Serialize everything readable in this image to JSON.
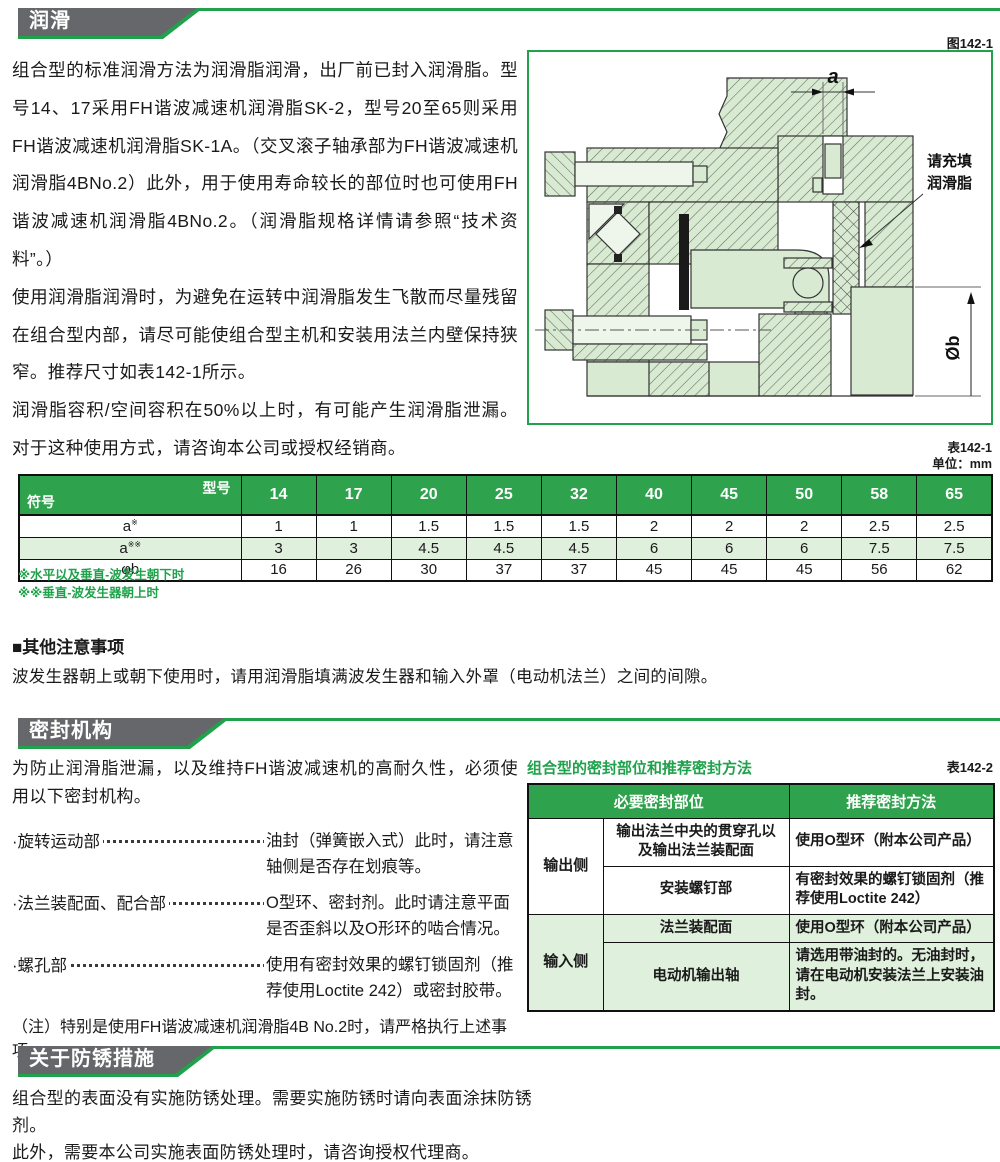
{
  "colors": {
    "green": "#1fa24b",
    "table_header_green": "#2fa24d",
    "light_green_row": "#dff0dc",
    "header_gray": "#66676a",
    "figure_fill": "#d9ead3"
  },
  "lubrication": {
    "header": "润滑",
    "paragraphs": [
      "组合型的标准润滑方法为润滑脂润滑，出厂前已封入润滑脂。型号14、17采用FH谐波减速机润滑脂SK-2，型号20至65则采用FH谐波减速机润滑脂SK-1A。（交叉滚子轴承部为FH谐波减速机润滑脂4BNo.2）此外，用于使用寿命较长的部位时也可使用FH谐波减速机润滑脂4BNo.2。（润滑脂规格详情请参照“技术资料”。）",
      "使用润滑脂润滑时，为避免在运转中润滑脂发生飞散而尽量残留在组合型内部，请尽可能使组合型主机和安装用法兰内壁保持狭窄。推荐尺寸如表142-1所示。",
      "润滑脂容积/空间容积在50%以上时，有可能产生润滑脂泄漏。对于这种使用方式，请咨询本公司或授权经销商。"
    ],
    "figure": {
      "label": "图142-1",
      "dim_a": "a",
      "dim_b": "Øb",
      "callout_line1": "请充填",
      "callout_line2": "润滑脂"
    },
    "table": {
      "label": "表142-1",
      "unit": "单位：mm",
      "corner_top": "型号",
      "corner_bottom": "符号",
      "columns": [
        "14",
        "17",
        "20",
        "25",
        "32",
        "40",
        "45",
        "50",
        "58",
        "65"
      ],
      "rows": [
        {
          "sym": "a",
          "sup": "※",
          "values": [
            "1",
            "1",
            "1.5",
            "1.5",
            "1.5",
            "2",
            "2",
            "2",
            "2.5",
            "2.5"
          ]
        },
        {
          "sym": "a",
          "sup": "※※",
          "values": [
            "3",
            "3",
            "4.5",
            "4.5",
            "4.5",
            "6",
            "6",
            "6",
            "7.5",
            "7.5"
          ]
        },
        {
          "sym": "φb",
          "sup": "",
          "values": [
            "16",
            "26",
            "30",
            "37",
            "37",
            "45",
            "45",
            "45",
            "56",
            "62"
          ]
        }
      ],
      "notes": [
        "※水平以及垂直-波发生朝下时",
        "※※垂直-波发生器朝上时"
      ]
    },
    "other": {
      "title": "■其他注意事项",
      "text": "波发生器朝上或朝下使用时，请用润滑脂填满波发生器和输入外罩（电动机法兰）之间的间隙。"
    }
  },
  "sealing": {
    "header": "密封机构",
    "intro": "为防止润滑脂泄漏，以及维持FH谐波减速机的高耐久性，必须使用以下密封机构。",
    "items": [
      {
        "label": "·旋转运动部",
        "desc": "油封（弹簧嵌入式）此时，请注意轴侧是否存在划痕等。"
      },
      {
        "label": "·法兰装配面、配合部",
        "desc": "O型环、密封剂。此时请注意平面是否歪斜以及O形环的啮合情况。"
      },
      {
        "label": "·螺孔部",
        "desc": "使用有密封效果的螺钉锁固剂（推荐使用Loctite 242）或密封胶带。"
      }
    ],
    "note": "（注）特别是使用FH谐波减速机润滑脂4B No.2时，请严格执行上述事项。",
    "table": {
      "title": "组合型的密封部位和推荐密封方法",
      "label": "表142-2",
      "col_part": "必要密封部位",
      "col_method": "推荐密封方法",
      "out_side": "输出侧",
      "in_side": "输入侧",
      "rows": [
        {
          "part": "输出法兰中央的贯穿孔以及输出法兰装配面",
          "method": "使用O型环（附本公司产品）"
        },
        {
          "part": "安装螺钉部",
          "method": "有密封效果的螺钉锁固剂（推荐使用Loctite 242）"
        },
        {
          "part": "法兰装配面",
          "method": "使用O型环（附本公司产品）"
        },
        {
          "part": "电动机输出轴",
          "method": "请选用带油封的。无油封时，请在电动机安装法兰上安装油封。"
        }
      ]
    }
  },
  "rust": {
    "header": "关于防锈措施",
    "paragraphs": [
      "组合型的表面没有实施防锈处理。需要实施防锈时请向表面涂抹防锈剂。",
      "此外，需要本公司实施表面防锈处理时，请咨询授权代理商。"
    ]
  }
}
